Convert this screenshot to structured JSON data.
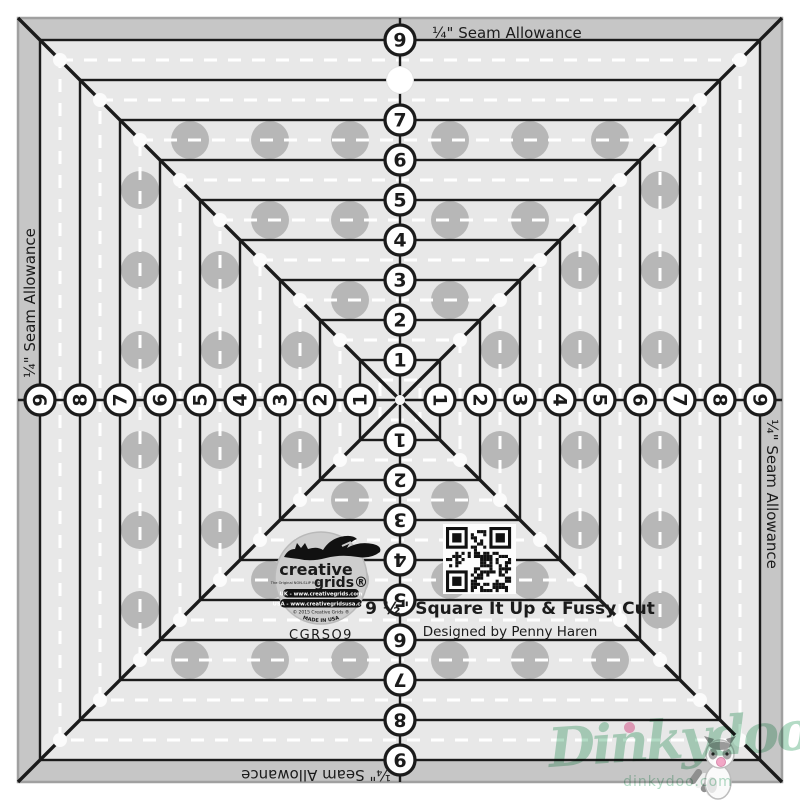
{
  "product": {
    "brand_word1": "creative",
    "brand_word2": "grids®",
    "brand_tagline": "The Original NON-SLIP Ruler",
    "url_uk": "UK - www.creativegrids.com",
    "url_usa": "USA - www.creativegridsusa.com",
    "copyright": "© 2015 Creative Grids ®",
    "made_in": "MADE IN USA",
    "sku": "CGRSQ9",
    "title": "9 ½\" Square It Up & Fussy Cut",
    "designer": "Designed by Penny Haren"
  },
  "ruler": {
    "seam_allowance_label": "¼\" Seam Allowance",
    "scale_numbers": [
      "1",
      "2",
      "3",
      "4",
      "5",
      "6",
      "7",
      "8",
      "9"
    ],
    "top_hole_position": "8"
  },
  "watermark": {
    "name": "Dinkydoo",
    "site": "dinkydoo.com"
  },
  "colors": {
    "ruler_body": "#e8e8e8",
    "seam_band": "#c6c6c6",
    "edge": "#a0a0a0",
    "line": "#1b1b1b",
    "dash": "#ffffff",
    "grip_dot": "#b7b7b7",
    "badge": "#cdcdcd",
    "watermark_green": "#b3dbc5",
    "watermark_pink": "#f2a7c6"
  }
}
